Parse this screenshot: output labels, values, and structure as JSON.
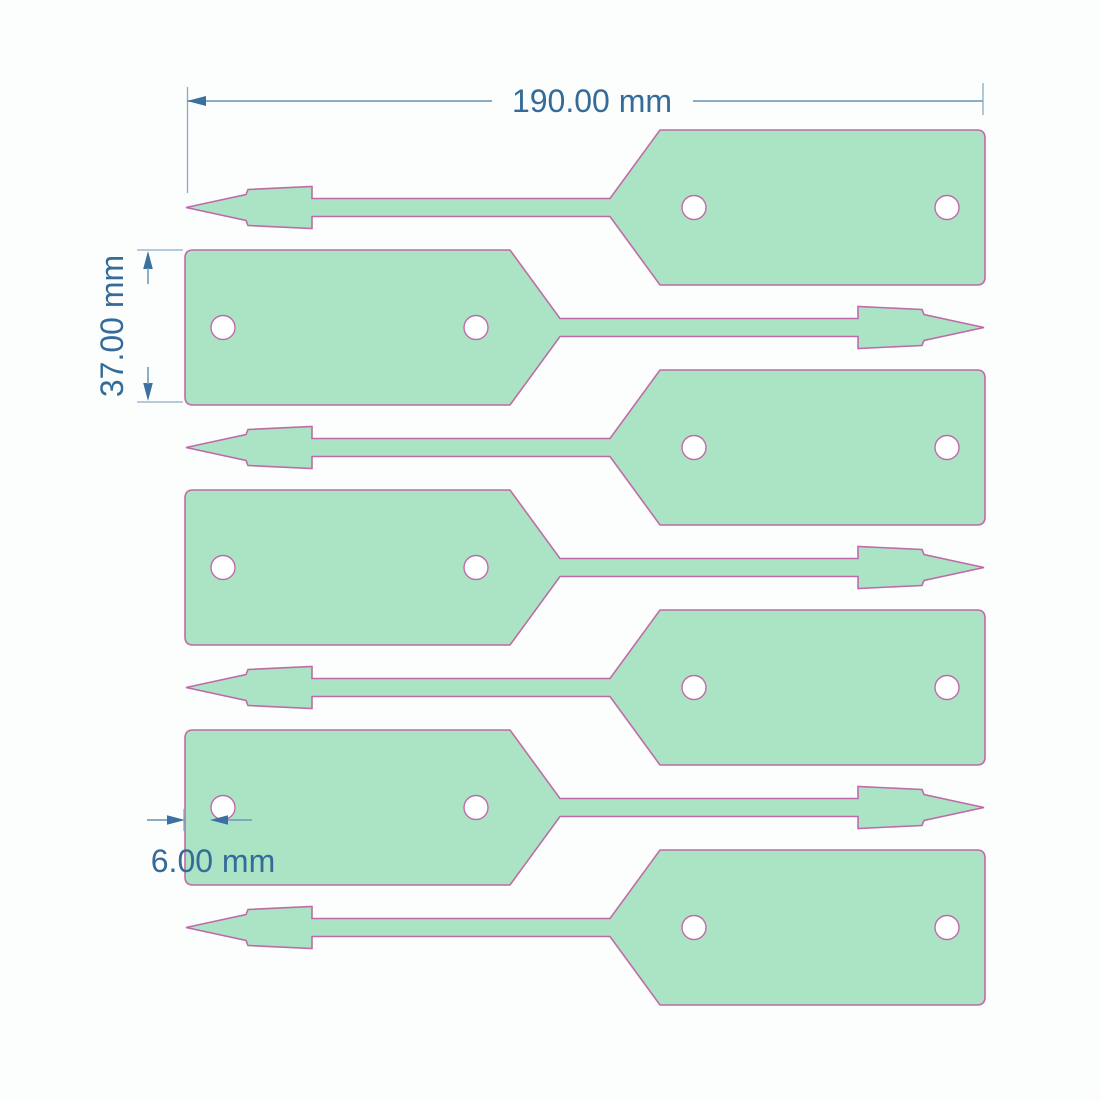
{
  "canvas": {
    "width": 1100,
    "height": 1100,
    "background": "#fcfdfd"
  },
  "colors": {
    "tag_fill": "#abe4c4",
    "tag_stroke": "#c06ba8",
    "dim_line": "#7aa0bf",
    "dim_ext": "#8aabc6",
    "dim_arrow": "#3b70a0",
    "dim_text": "#356b98",
    "hole_fill": "#ffffff"
  },
  "tag_geometry": {
    "body_w": 325,
    "body_h": 155,
    "taper_w": 50,
    "shaft_len": 298,
    "head_len": 126,
    "shaft_half": 9,
    "front_half": 13,
    "step_half": 18,
    "rear_half": 21,
    "front_len": 60,
    "step_len": 2,
    "corner_r": 8,
    "hole_r": 12,
    "hole_offsets": [
      38,
      291
    ]
  },
  "tags": [
    {
      "dir": "left",
      "x": 186,
      "y": 130
    },
    {
      "dir": "right",
      "x": 185,
      "y": 250
    },
    {
      "dir": "left",
      "x": 186,
      "y": 370
    },
    {
      "dir": "right",
      "x": 185,
      "y": 490
    },
    {
      "dir": "left",
      "x": 186,
      "y": 610
    },
    {
      "dir": "right",
      "x": 185,
      "y": 730
    },
    {
      "dir": "left",
      "x": 186,
      "y": 850
    }
  ],
  "dimensions": {
    "width": {
      "label": "190.00 mm",
      "value_mm": 190
    },
    "height": {
      "label": "37.00 mm",
      "value_mm": 37
    },
    "edge_to_hole": {
      "label": "6.00 mm",
      "value_mm": 6
    }
  }
}
